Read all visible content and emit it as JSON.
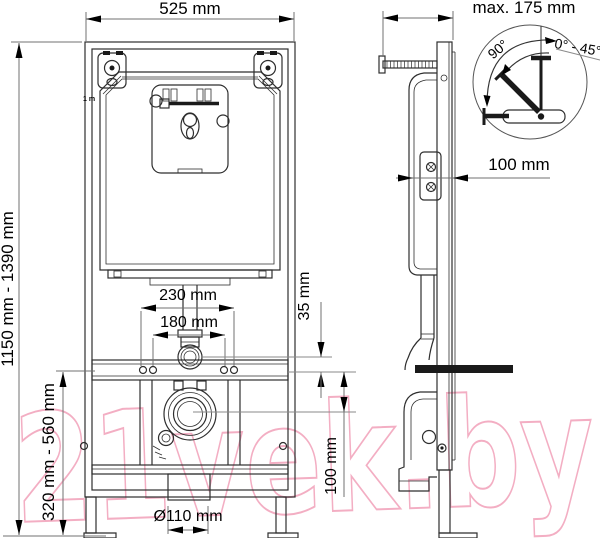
{
  "watermark": {
    "text": "21vek.by",
    "color": "#f3aec3"
  },
  "colors": {
    "drawing": "#2e2e2e",
    "dimension_lines": "#707070",
    "labels": "#000000",
    "background": "#ffffff"
  },
  "front_view": {
    "width_label": "525 mm",
    "height_range_label": "1150 mm - 1390 mm",
    "flush_bend_width_label": "230 mm",
    "fixing_spacing_label": "180 mm",
    "offset_label": "35 mm",
    "outlet_range_label": "320 mm - 560 mm",
    "outlet_height_label": "100 mm",
    "outlet_diameter_label": "Ø110 mm",
    "tank_marker_label": "1 m"
  },
  "side_view": {
    "max_depth_label": "max. 175 mm",
    "frame_depth_label": "100 mm",
    "bracket_detail": {
      "angle_sweep_label": "90°",
      "angle_range_label": "0° - 45°"
    }
  }
}
